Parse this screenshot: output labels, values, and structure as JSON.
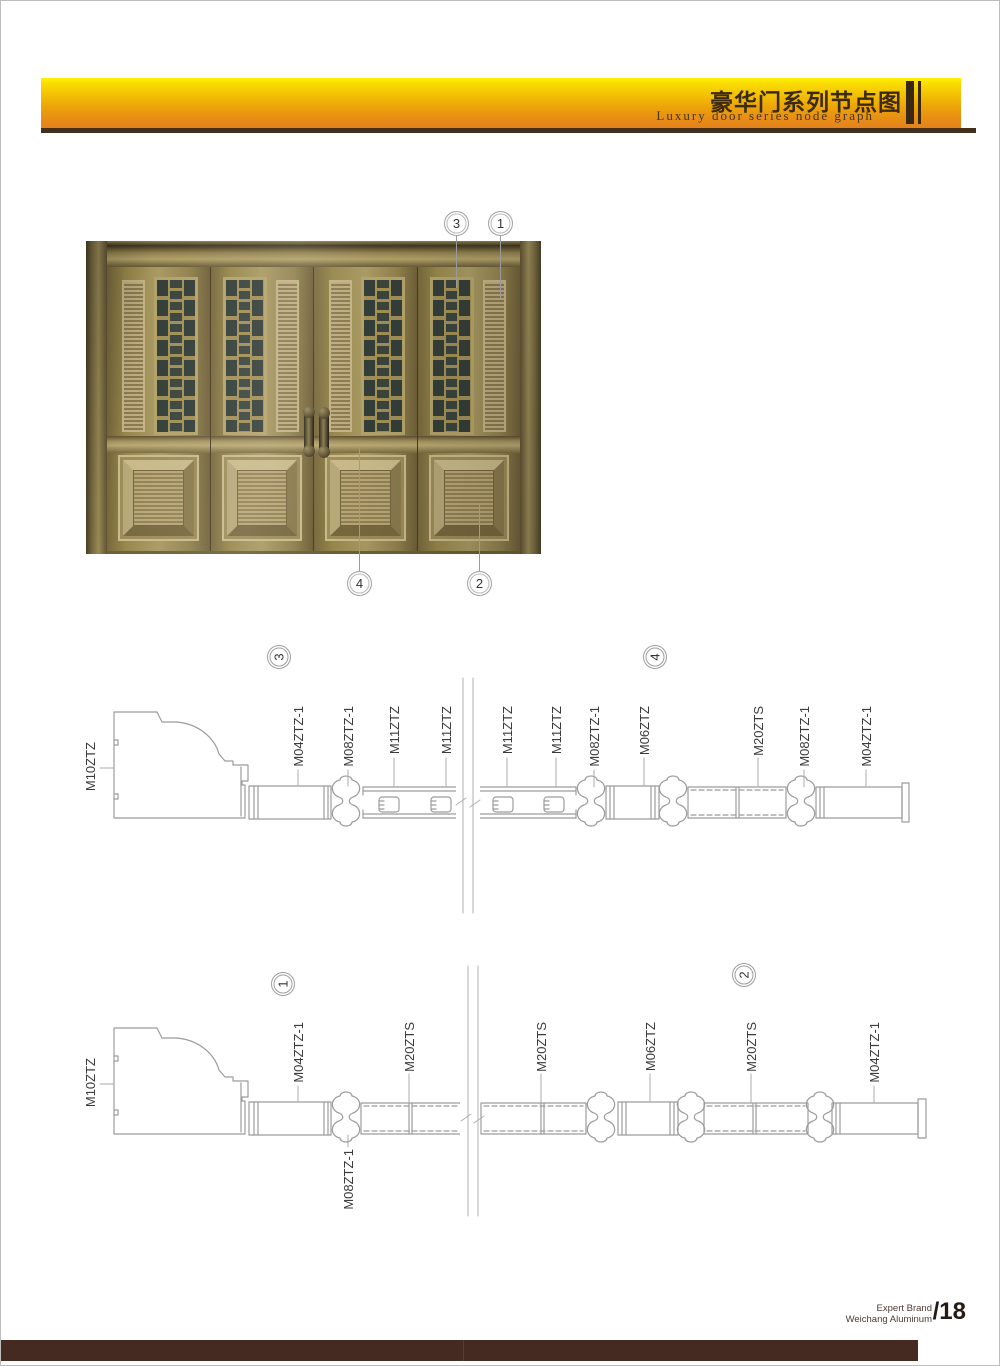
{
  "header": {
    "title_zh": "豪华门系列节点图",
    "title_en": "Luxury door series node graph",
    "banner_top_color": "#fff200",
    "banner_bottom_color": "#e4821e",
    "rule_color": "#42301d"
  },
  "door_figure": {
    "callouts": {
      "top_left": "3",
      "top_right": "1",
      "bottom_left": "4",
      "bottom_right": "2"
    }
  },
  "diagram_top": {
    "circle_left": "3",
    "circle_right": "4",
    "jamb_label": "M10ZTZ",
    "labels": [
      "M04ZTZ-1",
      "M08ZTZ-1",
      "M11ZTZ",
      "M11ZTZ",
      "M11ZTZ",
      "M11ZTZ",
      "M08ZTZ-1",
      "M06ZTZ",
      "M20ZTS",
      "M08ZTZ-1",
      "M04ZTZ-1"
    ]
  },
  "diagram_bottom": {
    "circle_left": "1",
    "circle_right": "2",
    "jamb_label": "M10ZTZ",
    "labels_above": [
      "M04ZTZ-1",
      "M20ZTS",
      "M20ZTS",
      "M06ZTZ",
      "M20ZTS",
      "M04ZTZ-1"
    ],
    "label_below": "M08ZTZ-1"
  },
  "footer": {
    "brand_line1": "Expert Brand",
    "brand_line2": "Weichang Aluminum",
    "page_number": "/18",
    "bar_color": "#452a22"
  }
}
